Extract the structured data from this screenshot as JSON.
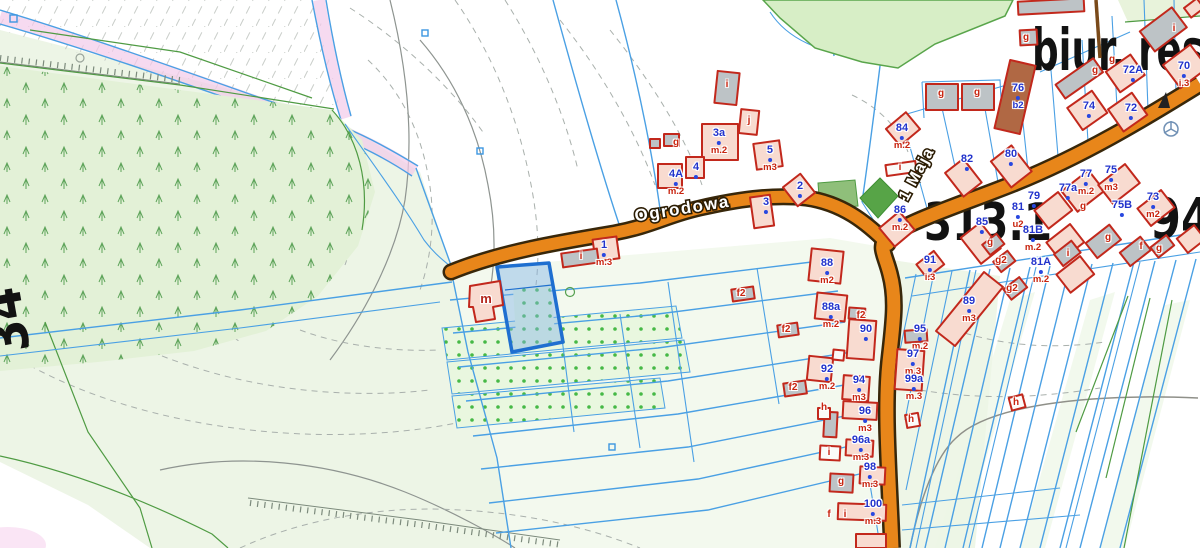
{
  "map": {
    "streets": {
      "ogrodowa": "Ogrodowa",
      "maja": "1 Maja"
    },
    "areas": {
      "biur": "biur. res",
      "d313": "313.1",
      "d94": "94",
      "d34": "34"
    },
    "addr": [
      {
        "n": "1",
        "u": "m.3"
      },
      {
        "n": "3a",
        "u": "m.2"
      },
      {
        "n": "4"
      },
      {
        "n": "4A",
        "u": "m.2"
      },
      {
        "n": "5",
        "u": "m3"
      },
      {
        "n": "2"
      },
      {
        "n": "3"
      },
      {
        "n": "76",
        "u": "b2"
      },
      {
        "n": "84",
        "u": "m.2"
      },
      {
        "n": "82"
      },
      {
        "n": "80"
      },
      {
        "n": "86",
        "u": "m.2"
      },
      {
        "n": "85"
      },
      {
        "n": "79"
      },
      {
        "n": "81",
        "u": "u2"
      },
      {
        "n": "81B",
        "u": "m.2"
      },
      {
        "n": "81A",
        "u": "m.2"
      },
      {
        "n": "91",
        "u": "i.3"
      },
      {
        "n": "77",
        "u": "m.2"
      },
      {
        "n": "77a"
      },
      {
        "n": "75",
        "u": "m3"
      },
      {
        "n": "75B"
      },
      {
        "n": "73",
        "u": "m2"
      },
      {
        "n": "74"
      },
      {
        "n": "72"
      },
      {
        "n": "72A"
      },
      {
        "n": "70",
        "u": "i.3"
      },
      {
        "n": "88",
        "u": "m2"
      },
      {
        "n": "88a",
        "u": "m.2"
      },
      {
        "n": "90"
      },
      {
        "n": "89",
        "u": "m3"
      },
      {
        "n": "95",
        "u": "m.2"
      },
      {
        "n": "92",
        "u": "m.2"
      },
      {
        "n": "94",
        "u": "m3"
      },
      {
        "n": "97",
        "u": "m.3"
      },
      {
        "n": "99a",
        "u": "m.3"
      },
      {
        "n": "96",
        "u": "m3"
      },
      {
        "n": "96a",
        "u": "m.3"
      },
      {
        "n": "98",
        "u": "m.3"
      },
      {
        "n": "100",
        "u": "m.3"
      }
    ],
    "lett": [
      "i",
      "j",
      "g",
      "m",
      "i",
      "i",
      "g",
      "g",
      "g",
      "g2",
      "g2",
      "g",
      "g",
      "i",
      "f",
      "g",
      "f2",
      "f2",
      "f2",
      "h",
      "h",
      "h",
      "i",
      "g",
      "f",
      "i",
      "i",
      "g",
      "g",
      "g",
      "f2"
    ],
    "colors": {
      "road_fill": "#e8861a",
      "road_casing": "#38270a",
      "parcel_line": "#4aa0e4",
      "building_stroke": "#c2281c",
      "residential_fill": "#f8dbd0",
      "utility_fill": "#bdc3c6",
      "selected_parcel": "#1f6fd0",
      "forest_fill": "#e3f1d7",
      "label_blue": "#2233cc",
      "label_red": "#c8240f"
    }
  }
}
